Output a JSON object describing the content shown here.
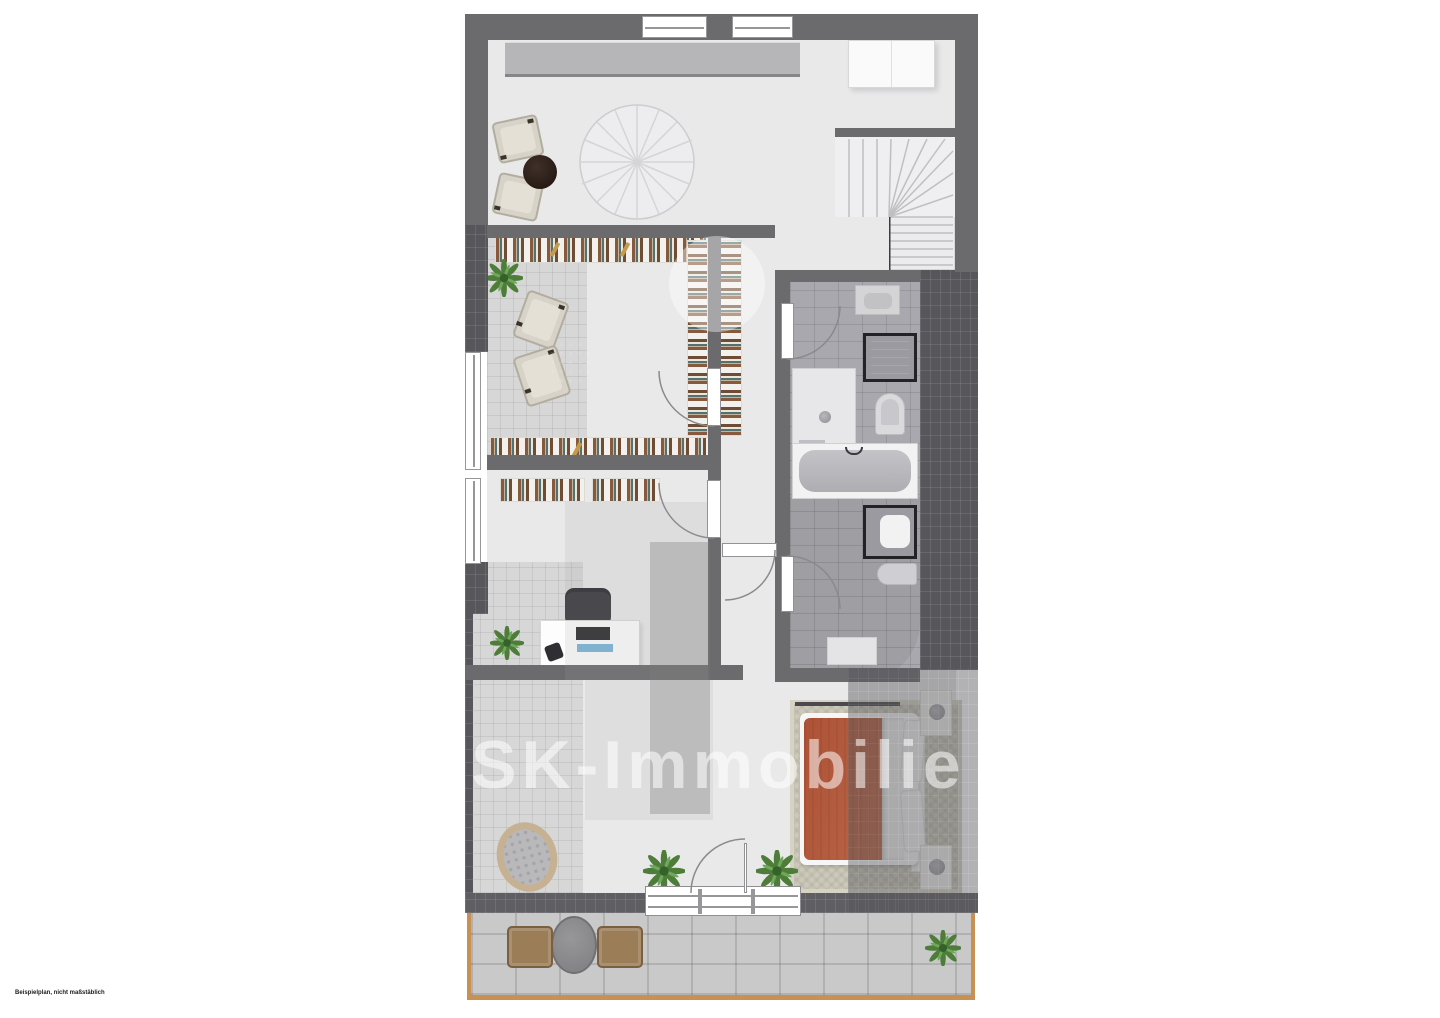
{
  "page": {
    "background": "#ffffff",
    "disclaimer_text": "Beispielplan, nicht maßstäblich"
  },
  "watermark": {
    "text": "KSK-Immobilie"
  },
  "palette": {
    "wall": "#6b6b6e",
    "floor_light": "#e9e9ea",
    "tile_light": "#d7d7d8",
    "tile_bath": "#a8a8ae",
    "tile_dark_roof": "#57575b",
    "paver": "#c9c9c9",
    "wood_border": "#c89152",
    "bed_red": "#b35a3d",
    "rug_beige": "#cdc9ba",
    "plant_green": "#4e7d3a",
    "table_dark": "#2c1e19"
  },
  "floorplan": {
    "type": "residential-floor-plan-top-view",
    "areas": [
      {
        "name": "living-area",
        "furnishings": [
          "sideboard",
          "two-armchairs",
          "round-side-table",
          "radial-round-rug",
          "white-cabinet",
          "winder-staircase"
        ]
      },
      {
        "name": "library-loggia",
        "furnishings": [
          "bookshelves-top",
          "bookshelves-right",
          "bookshelves-bottom",
          "plant",
          "two-armchairs",
          "round-coffee-table",
          "tiled-floor"
        ]
      },
      {
        "name": "office",
        "furnishings": [
          "wall-book-shelves",
          "desk",
          "office-chair",
          "monitor",
          "phone",
          "plant",
          "tiled-floor"
        ]
      },
      {
        "name": "bathroom-upper",
        "furnishings": [
          "vanity-sink",
          "framed-shower-unit",
          "toilet",
          "shower-enclosure",
          "door"
        ]
      },
      {
        "name": "bathroom-lower",
        "furnishings": [
          "bathtub",
          "framed-washbasin",
          "bidet",
          "bath-mat",
          "door"
        ]
      },
      {
        "name": "bedroom",
        "furnishings": [
          "double-bed-red-white",
          "two-nightstands-with-lamps",
          "beige-rug",
          "roof-slope-shading"
        ]
      },
      {
        "name": "garden-room",
        "furnishings": [
          "wicker-lounge-chair",
          "two-plants",
          "glass-door"
        ]
      },
      {
        "name": "terrace",
        "furnishings": [
          "round-table",
          "two-wicker-chairs",
          "plant",
          "wooden-edge"
        ]
      }
    ]
  }
}
